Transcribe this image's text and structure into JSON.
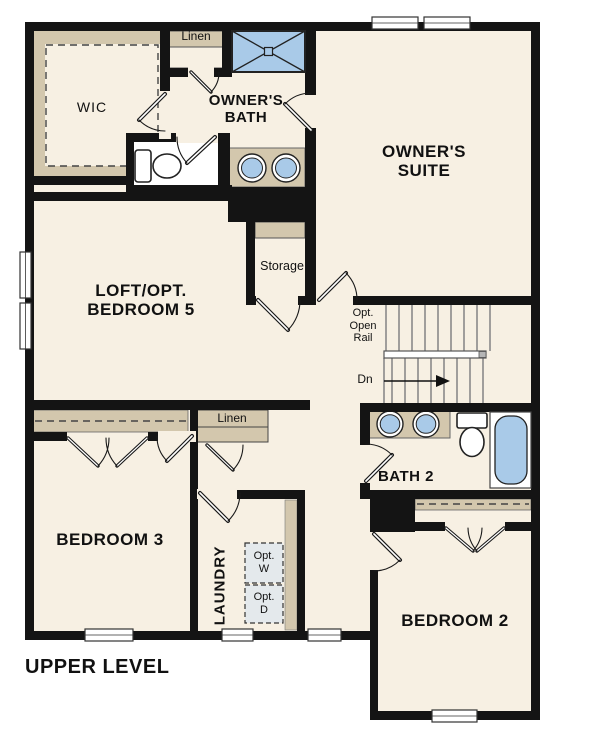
{
  "plan": {
    "title": "UPPER LEVEL",
    "labels": {
      "wic": "WIC",
      "linen_top": "Linen",
      "owners_bath": "OWNER'S\nBATH",
      "owners_suite": "OWNER'S\nSUITE",
      "loft": "LOFT/OPT.\nBEDROOM 5",
      "storage": "Storage",
      "opt_open_rail": "Opt.\nOpen\nRail",
      "dn": "Dn",
      "bath2": "BATH 2",
      "bedroom3": "BEDROOM 3",
      "linen_bottom": "Linen",
      "laundry": "LAUNDRY",
      "opt_w": "Opt.\nW",
      "opt_d": "Opt.\nD",
      "bedroom2": "BEDROOM 2"
    },
    "colors": {
      "floor": "#f7f0e3",
      "wall": "#141414",
      "cabinet_tan": "#d3c7ad",
      "fixture_blue": "#a9cae8",
      "appliance_gray": "#e4e9ec",
      "text": "#111111",
      "background": "#ffffff"
    }
  }
}
